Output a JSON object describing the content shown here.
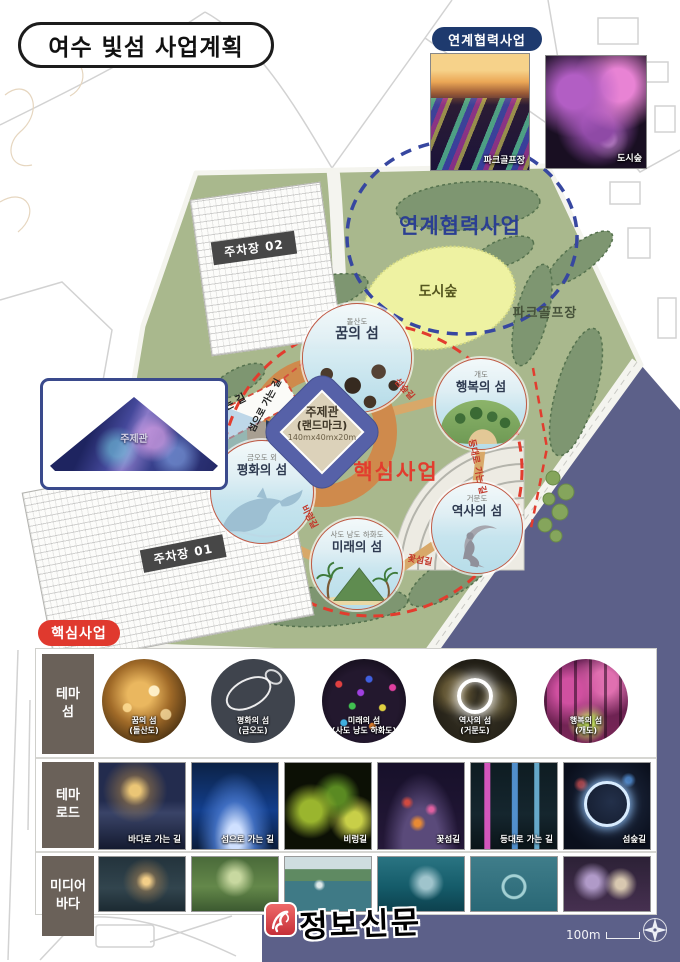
{
  "title": "여수 빛섬 사업계획",
  "colors": {
    "accent_red": "#e23c2e",
    "badge_navy": "#1e3a6e",
    "park_green": "#a9b88d",
    "sea_navy": "#5c6089",
    "link_blue": "#3747a0",
    "landmark_blue": "#5661a8"
  },
  "icons": {
    "compass": "compass-rose",
    "logo_mark": "quill",
    "inset_pointer": "arrow-right"
  },
  "linked": {
    "badge": "연계협력사업",
    "photos": [
      {
        "label": "파크골프장"
      },
      {
        "label": "도시숲"
      }
    ]
  },
  "map": {
    "zone_linked": "연계협력사업",
    "zone_core": "핵심사업",
    "city_forest": "도시숲",
    "park_golf": "파크골프장",
    "parking_02": "주차장 02",
    "parking_01": "주차장 01",
    "landmark": {
      "name": "주제관",
      "alias": "(랜드마크)",
      "size": "140mx40mx20m"
    },
    "inset_label": "주제관",
    "islands": {
      "dream": {
        "sub": "돌산도",
        "name": "꿈의 섬"
      },
      "happy": {
        "sub": "개도",
        "name": "행복의 섬"
      },
      "peace": {
        "sub": "금오도 외",
        "name": "평화의 섬"
      },
      "future": {
        "sub": "사도 낭도 하화도",
        "name": "미래의 섬"
      },
      "history": {
        "sub": "거문도",
        "name": "역사의 섬"
      }
    },
    "paths": {
      "to_sea": "바다로 가는 길",
      "to_island": "섬으로 가는 길",
      "island_forest": "섬숲길",
      "to_lighthouse": "등대로 가는 길",
      "flower": "꽃섬길",
      "byeorung": "비렁길"
    }
  },
  "core": {
    "badge": "핵심사업",
    "row_labels": {
      "island": {
        "l1": "테마",
        "l2": "섬"
      },
      "road": {
        "l1": "테마",
        "l2": "로드"
      },
      "media": {
        "l1": "미디어",
        "l2": "바다"
      }
    },
    "theme_islands": [
      {
        "name": "꿈의 섬",
        "sub": "(돌산도)"
      },
      {
        "name": "평화의 섬",
        "sub": "(금오도)"
      },
      {
        "name": "미래의 섬",
        "sub": "(사도 낭도 하화도)"
      },
      {
        "name": "역사의 섬",
        "sub": "(거문도)"
      },
      {
        "name": "행복의 섬",
        "sub": "(개도)"
      }
    ],
    "theme_roads": [
      "바다로 가는 길",
      "섬으로 가는 길",
      "비렁길",
      "꽃섬길",
      "등대로 가는 길",
      "섬숲길"
    ]
  },
  "footer": {
    "logo": "정보신문",
    "scale": "100m"
  }
}
